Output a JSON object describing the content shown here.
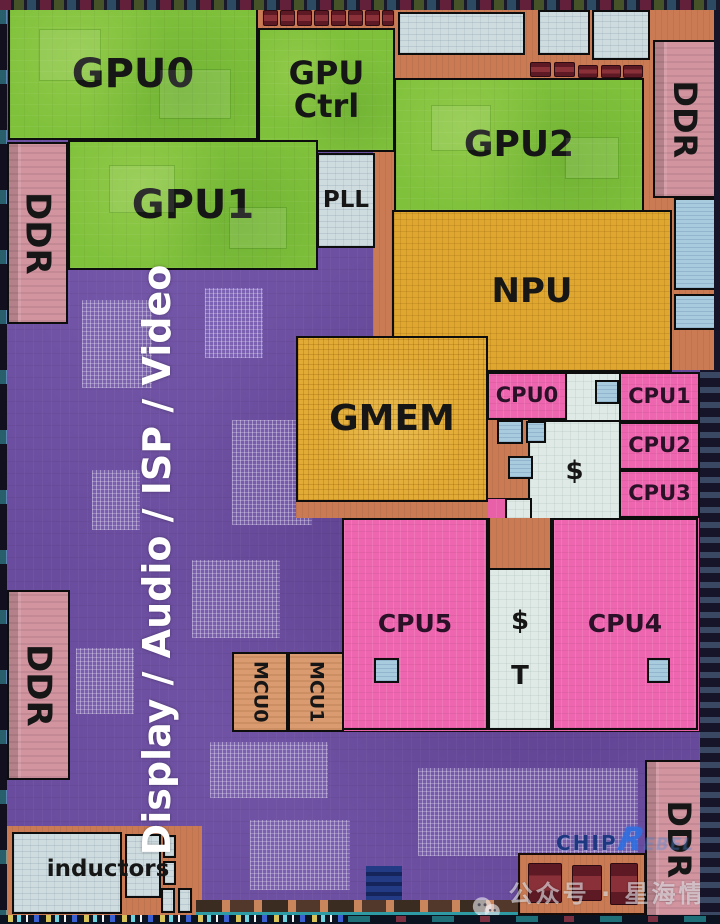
{
  "blocks": {
    "gpu0": {
      "label": "GPU0"
    },
    "gpu_ctrl": {
      "line1": "GPU",
      "line2": "Ctrl"
    },
    "gpu1": {
      "label": "GPU1"
    },
    "gpu2": {
      "label": "GPU2"
    },
    "pll": {
      "label": "PLL"
    },
    "npu": {
      "label": "NPU"
    },
    "gmem": {
      "label": "GMEM"
    },
    "cpu0": {
      "label": "CPU0"
    },
    "cpu1": {
      "label": "CPU1"
    },
    "cpu2": {
      "label": "CPU2"
    },
    "cpu3": {
      "label": "CPU3"
    },
    "cpu4": {
      "label": "CPU4"
    },
    "cpu5": {
      "label": "CPU5"
    },
    "l2_cache": {
      "label": "$"
    },
    "cpu45_cache": {
      "dollar": "$",
      "t": "T"
    },
    "ddr_top_left": {
      "label": "DDR"
    },
    "ddr_top_right": {
      "label": "DDR"
    },
    "ddr_bottom_left": {
      "label": "DDR"
    },
    "ddr_bottom_right": {
      "label": "DDR"
    },
    "mcu0": {
      "label": "MCU0"
    },
    "mcu1": {
      "label": "MCU1"
    },
    "inductors": {
      "label": "inductors"
    }
  },
  "overlay": {
    "subsystem_label": "Display / Audio / ISP / Video"
  },
  "watermarks": {
    "chip_logo_prefix": "CHIP",
    "chip_logo_r": "R",
    "chip_logo_suffix": "EBEL",
    "wechat_account": "公众号 · 星海情报局"
  },
  "colors": {
    "gpu_green": "#7fc13b",
    "npu_orange": "#dfa72f",
    "cpu_pink": "#ee66af",
    "fabric_purple": "#6a4c9e",
    "analog_salmon": "#ca7b54",
    "ddr_pink": "#d295a0",
    "cache_gray": "#dfe9e5",
    "sram_blue": "#a9cbde",
    "annotation_border": "#0d0d0d"
  }
}
